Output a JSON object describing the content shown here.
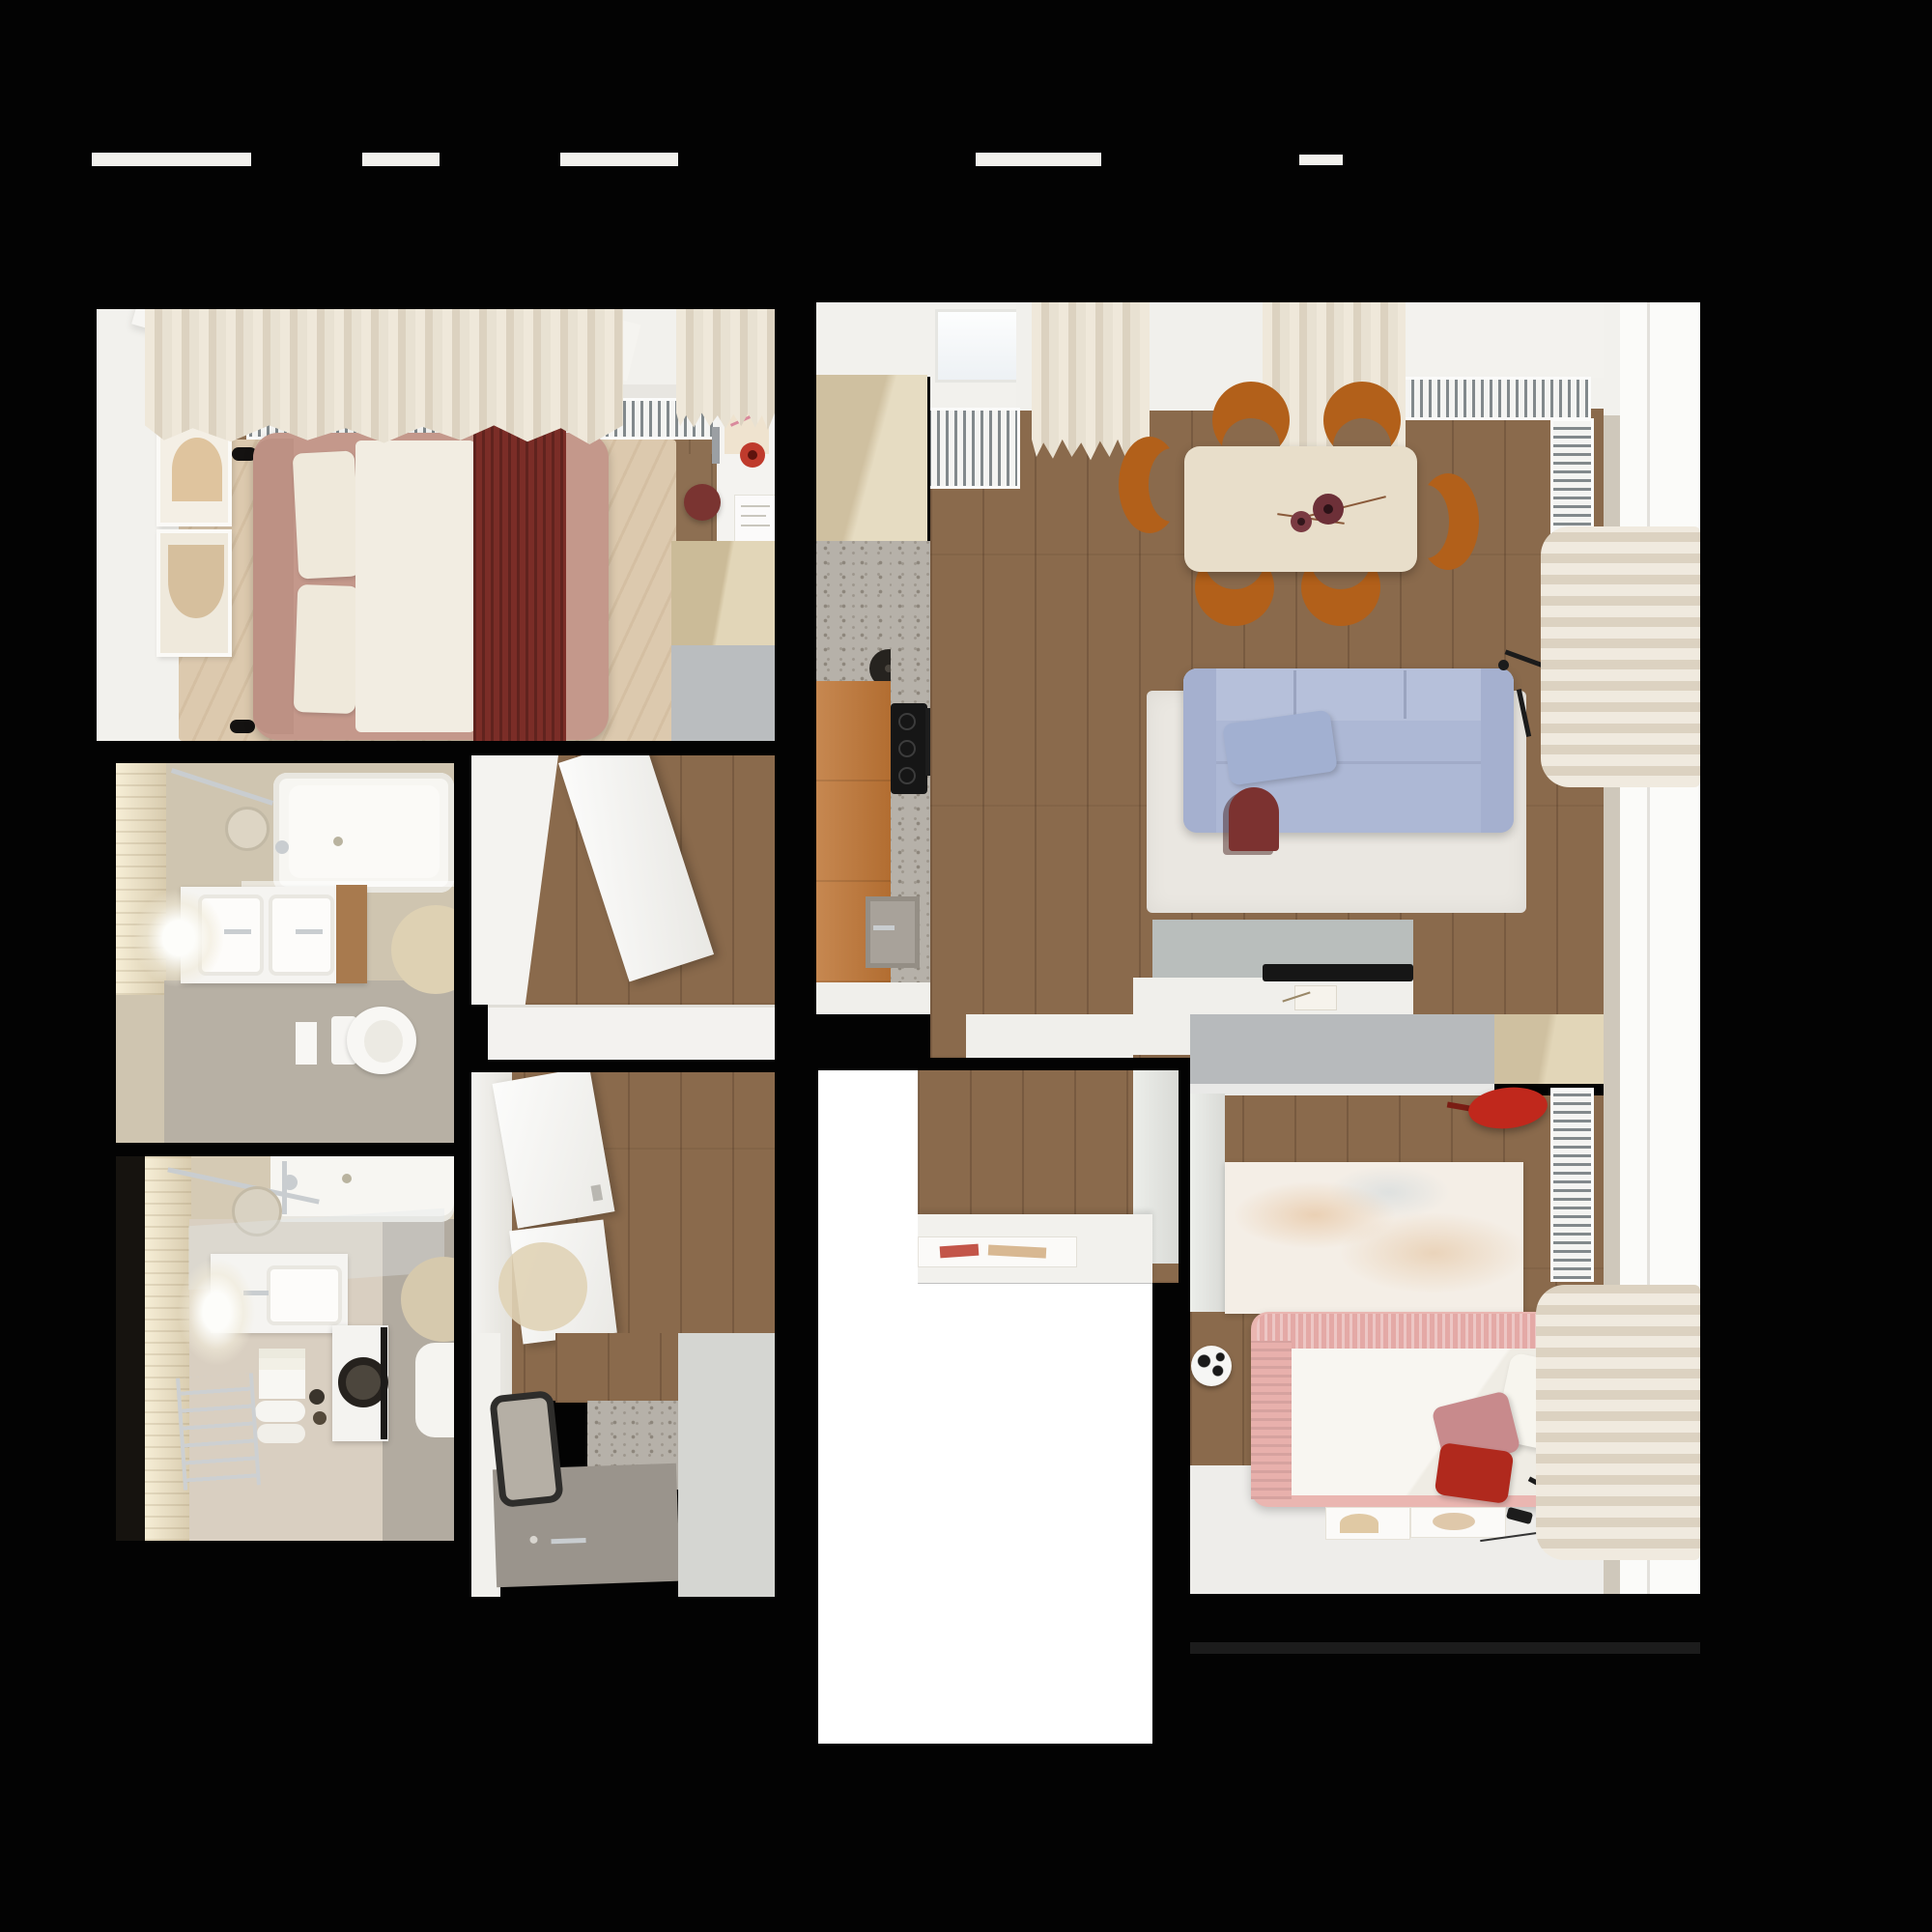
{
  "scene": {
    "kind": "apartment floor plan, top-down 3D render",
    "background": "#030303",
    "no_visible_text": true
  },
  "palette": {
    "white": "#f2f1ed",
    "wood-floor": "#8a6a4c",
    "wood-bedroom": "#8d6f52",
    "rug-beige": "#dcc9ae",
    "bed-pink": "#c4988b",
    "blanket-red": "#7b2d27",
    "duvet-white": "#f2ede2",
    "chair-orange": "#b2601a",
    "table-wood": "#e8deca",
    "sofa-blue": "#adb8d5",
    "rug-white": "#eae7e1",
    "accent-red": "#bf3a2c",
    "orange-cabinet": "#bd7434",
    "light-wood": "#dccdab",
    "terrazzo": "#b6b1a9",
    "gray-closet": "#b7babc",
    "tv-console": "#b9bebc",
    "kid-rug": "#f4eee6",
    "kid-bed-pink": "#eab6b1",
    "pillow-red": "#b0291d",
    "bath-wall": "#cfc5b0",
    "bath-floor": "#b7b0a4",
    "bath-floor2": "#d9cfc1",
    "chrome": "#c9cdd0",
    "void-white": "#ffffff",
    "window-white": "#fbfbf9"
  },
  "rooms": [
    {
      "id": "master-bedroom",
      "label": "Master bedroom",
      "furniture": [
        "double bed with red blanket",
        "beige rug",
        "radiator",
        "round side table with magazine",
        "two wall art frames",
        "two wall lamps",
        "desk with red vase and papers",
        "red stool",
        "wardrobe",
        "gray closet",
        "curtains",
        "windows"
      ]
    },
    {
      "id": "bathroom-top",
      "label": "Bathroom with tub and toilet",
      "furniture": [
        "bathtub",
        "shower head",
        "double sink vanity",
        "backlit mirror",
        "toilet",
        "round rug"
      ]
    },
    {
      "id": "bathroom-bottom",
      "label": "Bathroom with laundry",
      "furniture": [
        "bathtub",
        "shower rails",
        "sink vanity",
        "washing machine",
        "towels",
        "towel radiator",
        "round mirror",
        "round rug",
        "toilet"
      ]
    },
    {
      "id": "entry-hall",
      "label": "Entry hall",
      "furniture": [
        "open door",
        "white bench"
      ]
    },
    {
      "id": "corridor",
      "label": "Corridor with shower room",
      "furniture": [
        "flip-door shoe cabinets",
        "round rug",
        "dark framed mirror",
        "shower tray",
        "terrazzo wall"
      ]
    },
    {
      "id": "kitchen",
      "label": "Kitchen",
      "furniture": [
        "light wood upper cabinet",
        "terrazzo counter",
        "black kettle",
        "orange cabinets",
        "cooktop",
        "sink"
      ]
    },
    {
      "id": "living-dining",
      "label": "Living and dining room",
      "furniture": [
        "dining table with two dark red vases",
        "six orange chairs",
        "blue sofa with lumbar pillow",
        "dark red side table",
        "white shag rug",
        "TV console with TV",
        "floor lamp",
        "radiators",
        "curtains",
        "windows"
      ]
    },
    {
      "id": "study-nook",
      "label": "Study nook",
      "furniture": [
        "white desk",
        "flat artwork"
      ]
    },
    {
      "id": "kids-room",
      "label": "Kids room",
      "furniture": [
        "gray closet band",
        "red wall chair",
        "vertical radiator",
        "pale artwork rug",
        "football",
        "pink bed with pillows",
        "floor artworks",
        "black desk lamp",
        "curtains",
        "windows"
      ]
    }
  ]
}
